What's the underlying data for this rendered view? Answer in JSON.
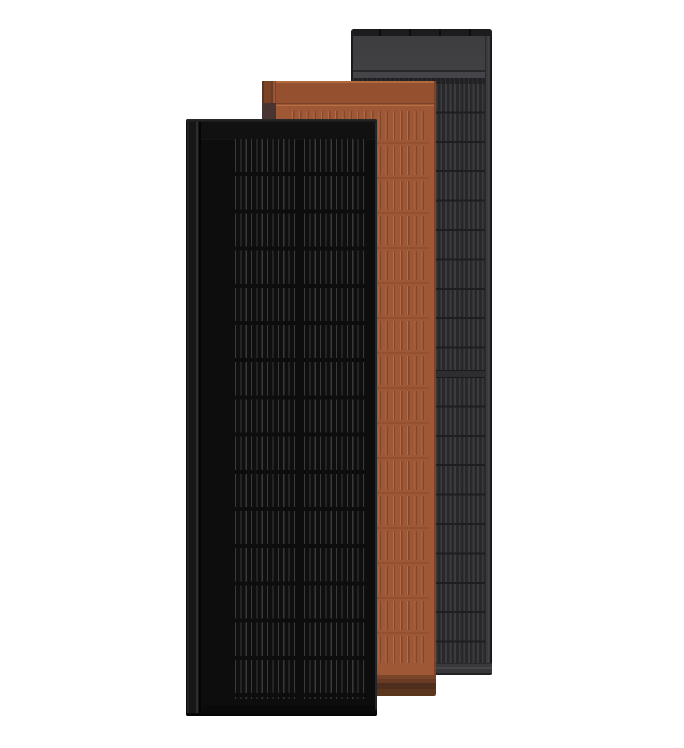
{
  "scene": {
    "type": "product-render",
    "panels": [
      {
        "id": "black-solar-panel",
        "position": "front-left"
      },
      {
        "id": "terracotta-solar-panel",
        "position": "middle"
      },
      {
        "id": "anthracite-solar-panel",
        "position": "rear-right"
      }
    ]
  },
  "colors": {
    "background": "#ffffff",
    "black_panel": {
      "face": "#0d0d0d",
      "flange": "#161616",
      "top_bar": "#111111",
      "cell_bg": "#0f0f0f",
      "busbar": "#3a3a3a",
      "edge_highlight": "#2b2b2b"
    },
    "terracotta_panel": {
      "top_edge": "#b2693f",
      "header": "#94502f",
      "body": "#9e5835",
      "ridge_groove": "#82462a",
      "ridge_highlight": "#b66c46",
      "row_seam": "#8a4a2c",
      "seam_dark": "#7a4126",
      "seam_light": "#b86f43",
      "flange": "#7a4227",
      "flange_shadow": "#4a3432",
      "bar_top": "#6a3b24",
      "bar_mid": "#4f2e1d",
      "bar_low": "#5c351f"
    },
    "gray_panel": {
      "top_strip": "#1c1c1e",
      "strip_mark": "#0d0d0e",
      "header": "#414144",
      "body_base": "#28282a",
      "stripe_light": "#3c3c3f",
      "row_line": "#1e1e20",
      "seam_band": "#2e2e30",
      "bottom_margin": "#3a3a3d",
      "flange": "#3b3b3e",
      "edge_dark": "#141416"
    }
  }
}
